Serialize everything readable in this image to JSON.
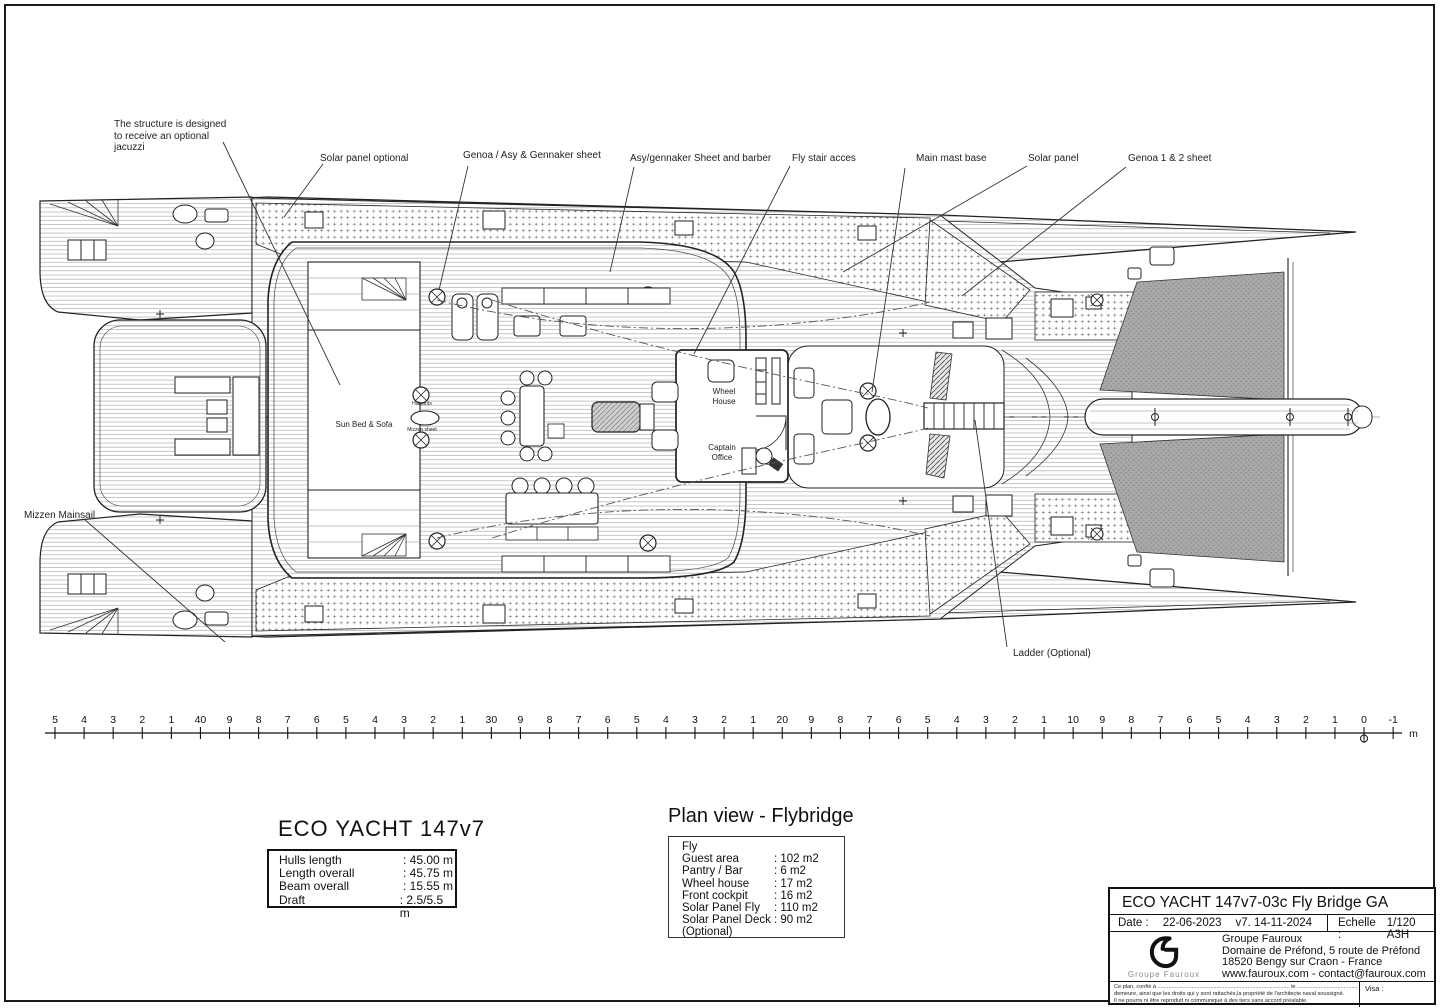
{
  "callouts": {
    "jacuzzi": "The structure is designed to receive an optional jacuzzi",
    "solar_panel_optional": "Solar panel optional",
    "genoa_asy_gennaker_sheet": "Genoa / Asy & Gennaker sheet",
    "asy_gennaker_sheet_barber": "Asy/gennaker Sheet and barber",
    "fly_stair_acces": "Fly stair acces",
    "main_mast_base": "Main mast base",
    "solar_panel": "Solar panel",
    "genoa_1_2_sheet": "Genoa 1 & 2 sheet",
    "mizzen_mainsail": "Mizzen Mainsail",
    "ladder_optional": "Ladder (Optional)"
  },
  "deck_labels": {
    "sun_bed_sofa": "Sun Bed & Sofa",
    "wheel_house": "Wheel House",
    "captain_office": "Captain Office",
    "halyards": "Halyards",
    "mizzen_sheet": "Mizzen sheet"
  },
  "specs": {
    "title": "ECO YACHT 147v7",
    "rows": [
      {
        "label": "Hulls length",
        "value": ": 45.00 m"
      },
      {
        "label": "Length overall",
        "value": ": 45.75 m"
      },
      {
        "label": "Beam overall",
        "value": ": 15.55 m"
      },
      {
        "label": "Draft",
        "value": ": 2.5/5.5 m"
      }
    ]
  },
  "areas": {
    "title": "Plan view - Flybridge",
    "rows": [
      {
        "label": "Fly",
        "value": ""
      },
      {
        "label": "Guest area",
        "value": ": 102 m2"
      },
      {
        "label": "Pantry / Bar",
        "value": ": 6 m2"
      },
      {
        "label": "Wheel house",
        "value": ": 17 m2"
      },
      {
        "label": "Front cockpit",
        "value": ": 16 m2"
      },
      {
        "label": "Solar Panel Fly",
        "value": ": 110 m2"
      },
      {
        "label": "Solar Panel Deck",
        "value": ": 90 m2"
      },
      {
        "label": "(Optional)",
        "value": ""
      }
    ]
  },
  "ruler": {
    "labels": [
      "5",
      "4",
      "3",
      "2",
      "1",
      "40",
      "9",
      "8",
      "7",
      "6",
      "5",
      "4",
      "3",
      "2",
      "1",
      "30",
      "9",
      "8",
      "7",
      "6",
      "5",
      "4",
      "3",
      "2",
      "1",
      "20",
      "9",
      "8",
      "7",
      "6",
      "5",
      "4",
      "3",
      "2",
      "1",
      "10",
      "9",
      "8",
      "7",
      "6",
      "5",
      "4",
      "3",
      "2",
      "1",
      "0",
      "-1"
    ],
    "unit": "m"
  },
  "title_block": {
    "title": "ECO YACHT 147v7-03c  Fly Bridge GA",
    "date_label": "Date :",
    "date": "22-06-2023",
    "version": "v7. 14-11-2024",
    "scale_label": "Echelle :",
    "scale": "1/120 A3H",
    "company": "Groupe Fauroux",
    "address1": "Domaine de Préfond, 5 route de Préfond",
    "address2": "18520 Bengy sur Craon - France",
    "web": "www.fauroux.com - contact@fauroux.com",
    "logo_caption": "Groupe Fauroux",
    "legal1": "Ce plan, confié à ..................................................................................... le ......................................,",
    "legal2": "demeure, ainsi que les droits qui y sont rattachés,la propriété de l'architecte naval soussigné.",
    "legal3": "Il ne pourra ni être reproduit ni communiqué à des tiers sans accord préalable.",
    "visa_label": "Visa :"
  }
}
